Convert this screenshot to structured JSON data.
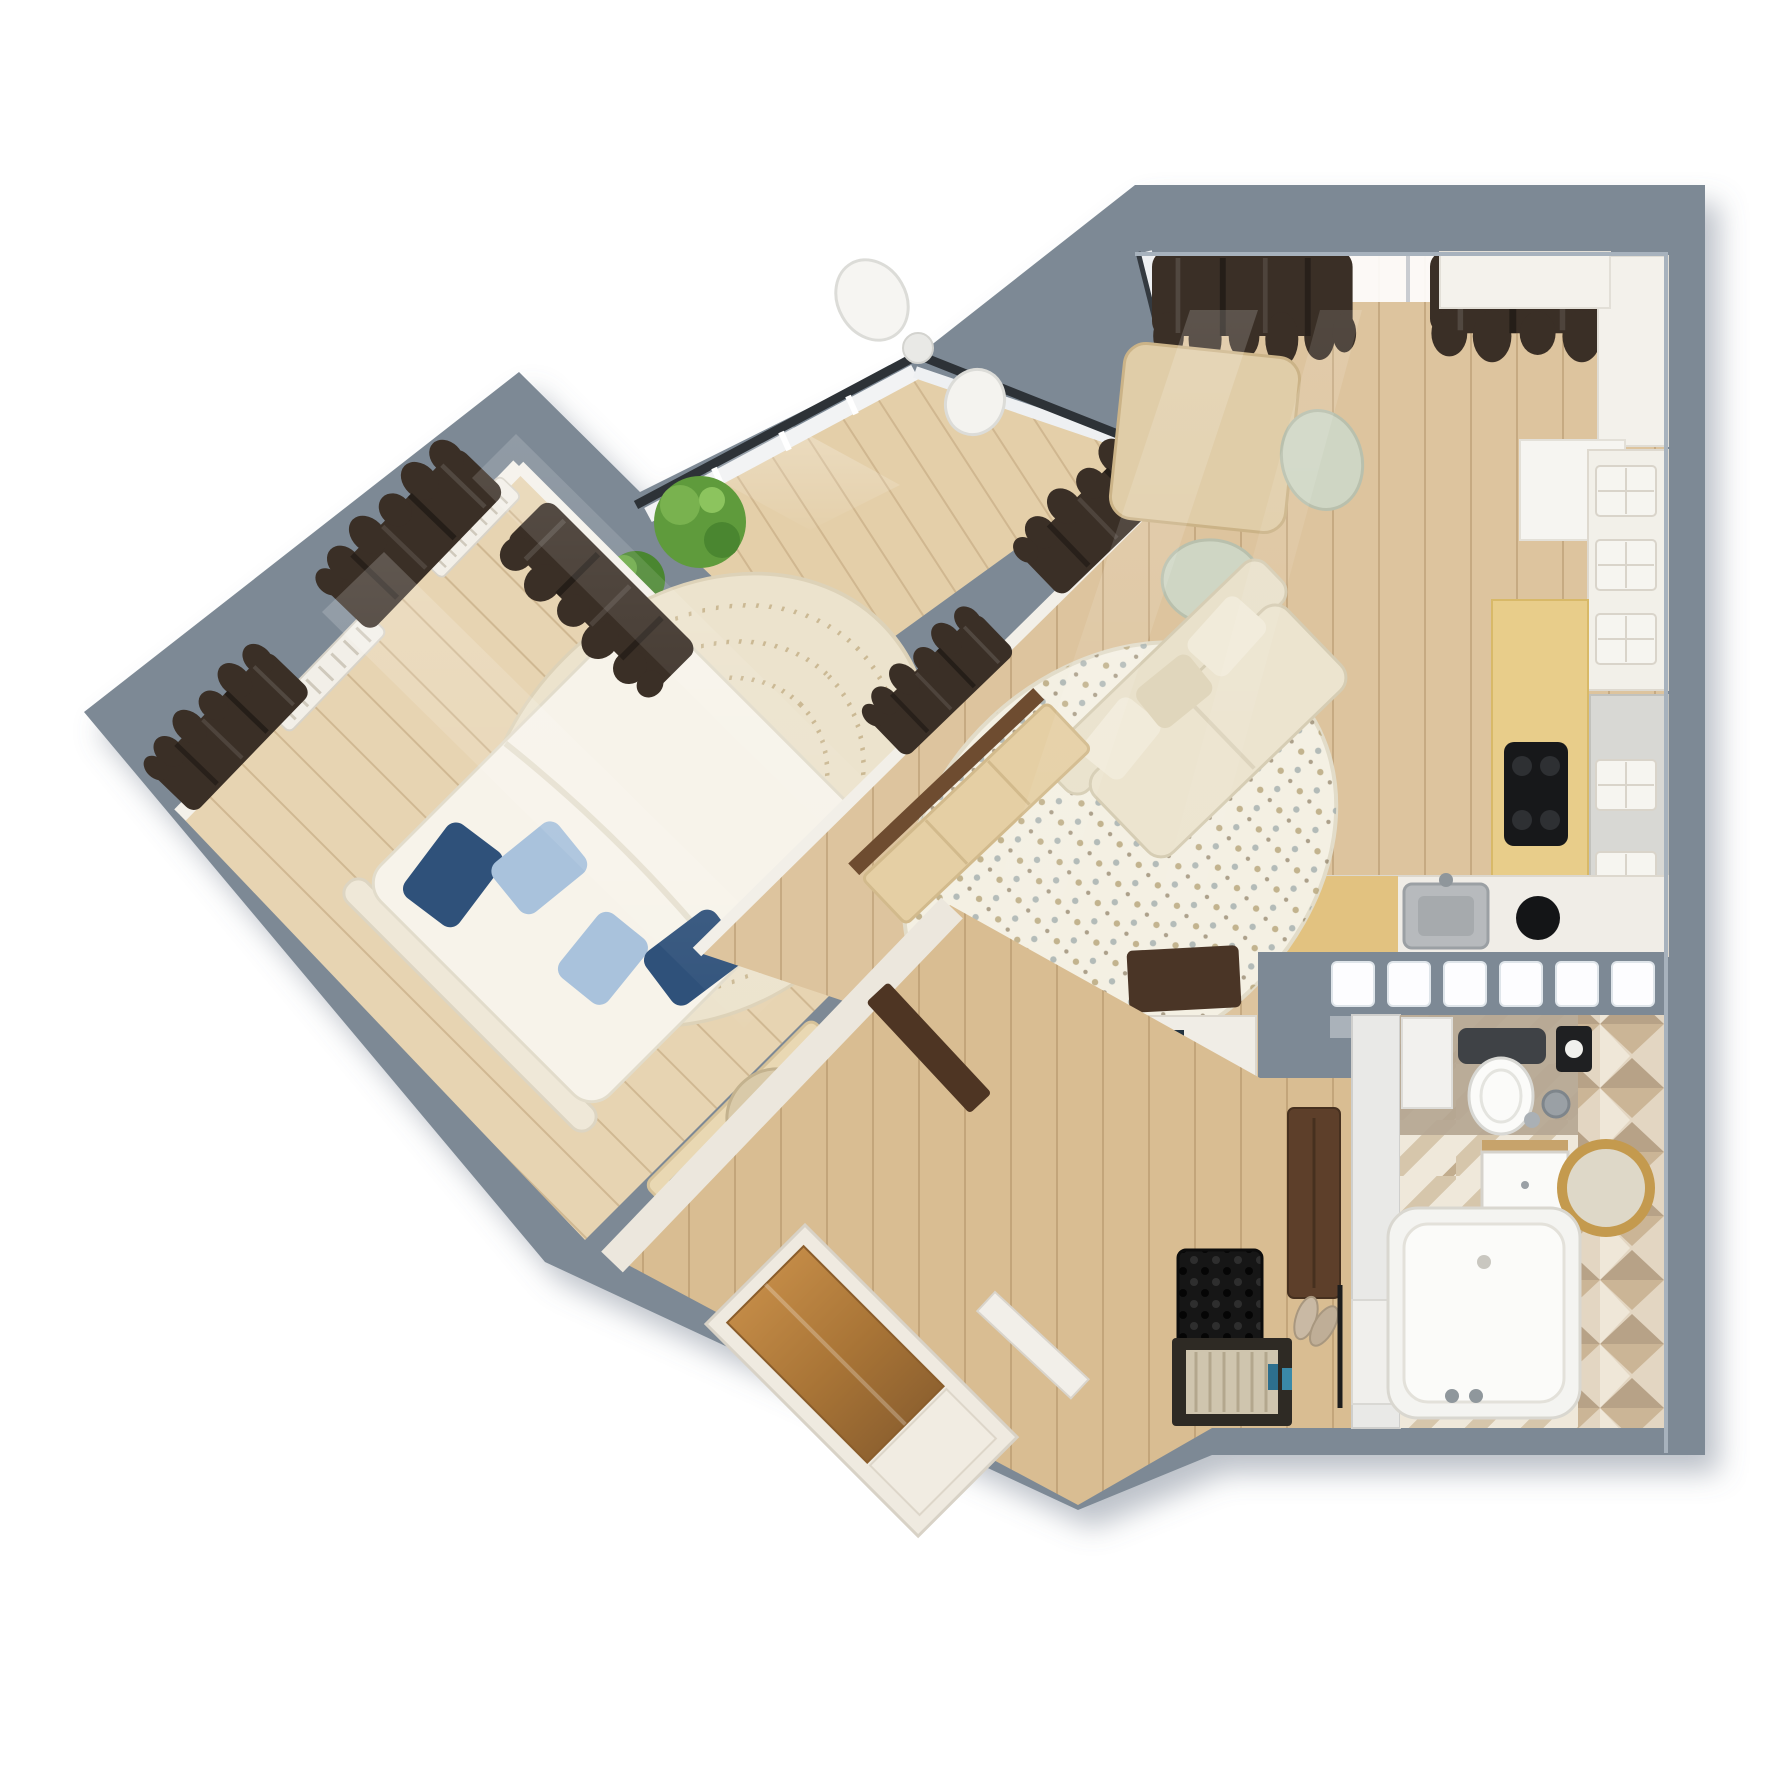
{
  "scene": {
    "type": "3d-floor-plan-top-view",
    "background": "#ffffff",
    "description": "Photorealistic top-down 3D render of a one-bedroom apartment rotated at an angle"
  },
  "palette": {
    "wall": "#7d8995",
    "wall_light": "#98a4b0",
    "wall_dark": "#5e6a77",
    "floor_bedroom": "#e7d4b2",
    "floor_living": "#ddc49e",
    "floor_hall": "#d9bd92",
    "floor_balcony": "#e4cfa9",
    "curtain": "#3a2f26",
    "rug_bedroom": "#ece3cd",
    "rug_living": "#f4f0e3",
    "sofa": "#e9e1cb",
    "bed_duvet": "#f7f3ea",
    "pillow_navy": "#2f517a",
    "pillow_blue": "#a9c2dc",
    "wood_furniture": "#e0cda8",
    "wardrobe_door": "#b9813f",
    "walnut": "#4e3523",
    "countertop": "#e8cd8a",
    "cooktop": "#17181a",
    "bath_tile": "#d8c8b0",
    "mirror_gold": "#c49a4e",
    "plant": "#5f9b3c",
    "glass_block": "#fdfdff",
    "white_trim": "#f3f1ea"
  },
  "rooms": {
    "bedroom": {
      "label": "Bedroom",
      "furniture": [
        "double-bed",
        "navy-and-blue-pillows",
        "round-patterned-rug",
        "desk-with-keyboard",
        "desk-chair",
        "radiators",
        "dark-blackout-curtains",
        "corner-windows"
      ]
    },
    "balcony": {
      "label": "Glazed balcony",
      "furniture": [
        "white-armchairs",
        "side-table",
        "potted-plants",
        "panoramic-glazing",
        "dark-rail-cap"
      ]
    },
    "living_kitchen": {
      "label": "Living room with kitchen",
      "furniture": [
        "square-dining-table",
        "two-shell-chairs",
        "beige-sofa",
        "dotted-oval-rug",
        "wood-sideboard",
        "white-kitchen-cabinets",
        "yellow-worktop",
        "black-cooktop",
        "extractor-hood",
        "steel-sink",
        "dark-doormat",
        "dark-blackout-curtains"
      ]
    },
    "hallway": {
      "label": "Hallway",
      "furniture": [
        "sliding-wardrobe-wood-door",
        "open-walnut-door",
        "dark-wall-cabinet",
        "black-shoe-grid",
        "framed-doormat",
        "shoes",
        "entrance-door"
      ]
    },
    "bathroom": {
      "label": "Bathroom",
      "furniture": [
        "bathtub",
        "toilet-with-dark-tank",
        "paper-dispenser",
        "vanity-cabinet-wood-top",
        "gold-round-mirror",
        "geometric-3d-tile-wall",
        "chevron-tile-floor",
        "glass-block-window"
      ]
    }
  }
}
